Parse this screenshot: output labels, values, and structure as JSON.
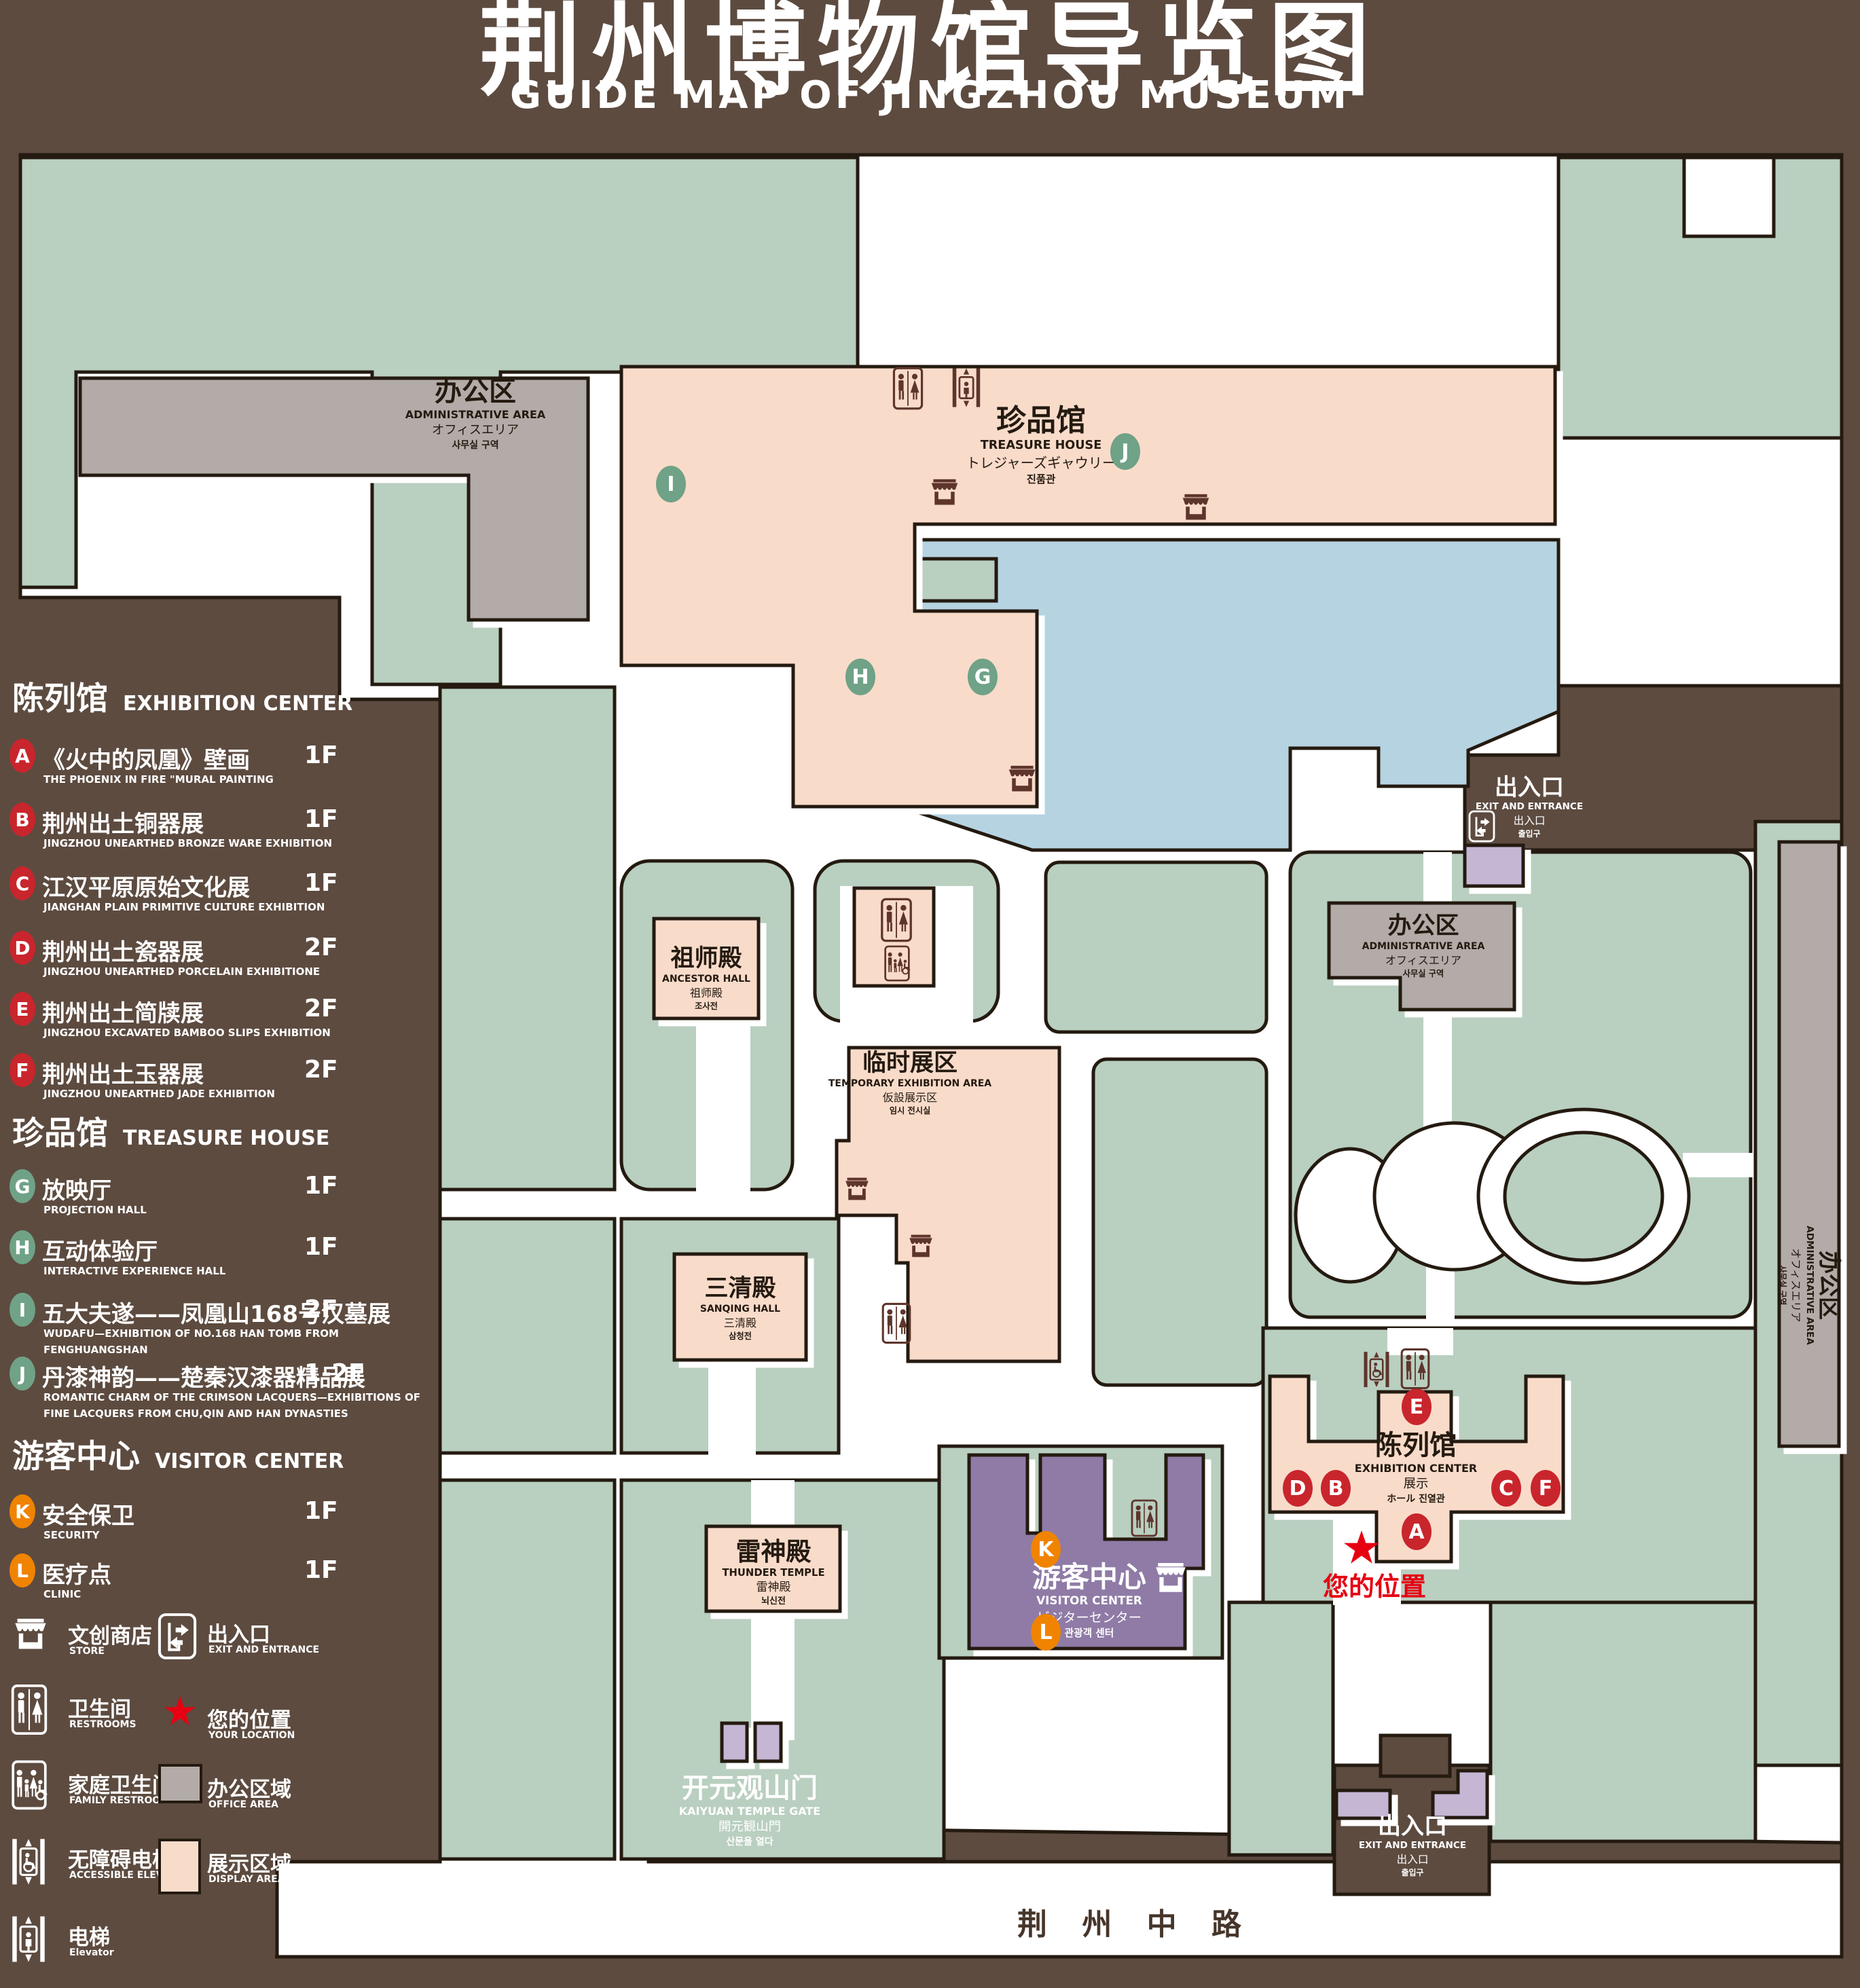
{
  "title": {
    "cn": "荆州博物馆导览图",
    "en": "GUIDE MAP OF JINGZHOU MUSEUM"
  },
  "legend": {
    "sections": [
      {
        "cn": "陈列馆",
        "en": "EXHIBITION CENTER",
        "badge_color": "#c9252d",
        "items": [
          {
            "letter": "A",
            "cn": "《火中的凤凰》壁画",
            "en": "THE PHOENIX IN FIRE \"MURAL PAINTING",
            "floor": "1F"
          },
          {
            "letter": "B",
            "cn": "荆州出土铜器展",
            "en": "JINGZHOU UNEARTHED BRONZE WARE EXHIBITION",
            "floor": "1F"
          },
          {
            "letter": "C",
            "cn": "江汉平原原始文化展",
            "en": "JIANGHAN PLAIN PRIMITIVE CULTURE EXHIBITION",
            "floor": "1F"
          },
          {
            "letter": "D",
            "cn": "荆州出土瓷器展",
            "en": "JINGZHOU UNEARTHED PORCELAIN EXHIBITIONE",
            "floor": "2F"
          },
          {
            "letter": "E",
            "cn": "荆州出土简牍展",
            "en": "JINGZHOU EXCAVATED BAMBOO SLIPS EXHIBITION",
            "floor": "2F"
          },
          {
            "letter": "F",
            "cn": "荆州出土玉器展",
            "en": "JINGZHOU UNEARTHED JADE EXHIBITION",
            "floor": "2F"
          }
        ]
      },
      {
        "cn": "珍品馆",
        "en": "TREASURE HOUSE",
        "badge_color": "#6fa287",
        "items": [
          {
            "letter": "G",
            "cn": "放映厅",
            "en": "PROJECTION HALL",
            "floor": "1F"
          },
          {
            "letter": "H",
            "cn": "互动体验厅",
            "en": "INTERACTIVE EXPERIENCE HALL",
            "floor": "1F"
          },
          {
            "letter": "I",
            "cn": "五大夫遂——凤凰山168号汉墓展",
            "en": "WUDAFU—EXHIBITION OF NO.168 HAN TOMB FROM FENGHUANGSHAN",
            "floor": "2F"
          },
          {
            "letter": "J",
            "cn": "丹漆神韵——楚秦汉漆器精品展",
            "en": "ROMANTIC CHARM OF THE CRIMSON LACQUERS—EXHIBITIONS OF FINE LACQUERS FROM CHU,QIN AND HAN DYNASTIES",
            "floor": "1-2F"
          }
        ]
      },
      {
        "cn": "游客中心",
        "en": "VISITOR CENTER",
        "badge_color": "#f08300",
        "items": [
          {
            "letter": "K",
            "cn": "安全保卫",
            "en": "SECURITY",
            "floor": "1F"
          },
          {
            "letter": "L",
            "cn": "医疗点",
            "en": "CLINIC",
            "floor": "1F"
          }
        ]
      }
    ],
    "symbols": [
      {
        "icon": "store-icon",
        "cn": "文创商店",
        "en": "STORE"
      },
      {
        "icon": "restroom-icon",
        "cn": "卫生间",
        "en": "RESTROOMS"
      },
      {
        "icon": "family-restroom-icon",
        "cn": "家庭卫生间",
        "en": "FAMILY RESTROOMS"
      },
      {
        "icon": "accessible-elevator-icon",
        "cn": "无障碍电梯",
        "en": "ACCESSIBLE ELEVATOR"
      },
      {
        "icon": "elevator-icon",
        "cn": "电梯",
        "en": "Elevator"
      },
      {
        "icon": "exit-door-icon",
        "cn": "出入口",
        "en": "EXIT AND ENTRANCE"
      },
      {
        "icon": "your-location-star-icon",
        "cn": "您的位置",
        "en": "YOUR LOCATION"
      },
      {
        "icon": "office-area-swatch",
        "cn": "办公区域",
        "en": "OFFICE AREA"
      },
      {
        "icon": "display-area-swatch",
        "cn": "展示区域",
        "en": "DISPLAY AREA"
      }
    ]
  },
  "map_labels": {
    "admin-area-nw": {
      "lines": [
        "办公区",
        "ADMINISTRATIVE AREA",
        "オフィスエリア",
        "사무실 구역"
      ]
    },
    "treasure-house": {
      "lines": [
        "珍品馆",
        "TREASURE HOUSE",
        "トレジャーズギャウリー",
        "진품관"
      ]
    },
    "ancestor-hall": {
      "lines": [
        "祖师殿",
        "ANCESTOR HALL",
        "祖师殿",
        "조사전"
      ]
    },
    "temporary-exhibition-area": {
      "lines": [
        "临时展区",
        "TEMPORARY EXHIBITION AREA",
        "仮設展示区",
        "임시 전시실"
      ]
    },
    "admin-area-east": {
      "lines": [
        "办公区",
        "ADMINISTRATIVE AREA",
        "オフィスエリア",
        "사무실 구역"
      ]
    },
    "admin-area-right-column": {
      "lines": [
        "办公区",
        "ADMINISTRATIVE AREA",
        "オフィスエリア",
        "사무실 구역"
      ]
    },
    "sanqing-hall": {
      "lines": [
        "三清殿",
        "SANQING HALL",
        "三清殿",
        "삼청전"
      ]
    },
    "thunder-temple": {
      "lines": [
        "雷神殿",
        "THUNDER TEMPLE",
        "雷神殿",
        "뇌신전"
      ]
    },
    "visitor-center": {
      "lines": [
        "游客中心",
        "VISITOR CENTER",
        "ビジターセンター",
        "관광객 센터"
      ]
    },
    "exhibition-center": {
      "lines": [
        "陈列馆",
        "EXHIBITION CENTER",
        "展示",
        "ホール 진열관"
      ]
    },
    "exit-northeast": {
      "lines": [
        "出入口",
        "EXIT AND ENTRANCE",
        "出入口",
        "출입구"
      ]
    },
    "exit-south": {
      "lines": [
        "出入口",
        "EXIT AND ENTRANCE",
        "出入口",
        "출입구"
      ]
    },
    "kaiyuan-temple-gate": {
      "lines": [
        "开元观山门",
        "KAIYUAN TEMPLE GATE",
        "開元観山門",
        "산문을 열다"
      ]
    },
    "road": {
      "lines": [
        "荆 州 中 路"
      ]
    },
    "your-location": {
      "lines": [
        "您的位置"
      ]
    }
  },
  "markers": [
    {
      "letter": "A",
      "group": "red"
    },
    {
      "letter": "B",
      "group": "red"
    },
    {
      "letter": "C",
      "group": "red"
    },
    {
      "letter": "D",
      "group": "red"
    },
    {
      "letter": "E",
      "group": "red"
    },
    {
      "letter": "F",
      "group": "red"
    },
    {
      "letter": "G",
      "group": "green"
    },
    {
      "letter": "H",
      "group": "green"
    },
    {
      "letter": "I",
      "group": "green"
    },
    {
      "letter": "J",
      "group": "green"
    },
    {
      "letter": "K",
      "group": "orange"
    },
    {
      "letter": "L",
      "group": "orange"
    }
  ],
  "colors": {
    "background": "#5d4b40",
    "ground_green": "#b9cfc0",
    "display_area_pink": "#f9dbca",
    "office_area_gray": "#b2aba7",
    "visitor_center_purple": "#8f7ba6",
    "gate_purple": "#c5b6d4",
    "lake_blue": "#b6d3e1",
    "outline": "#241a10",
    "icon_maroon": "#5e352b",
    "badge_red": "#c9252d",
    "badge_green": "#6fa287",
    "badge_orange": "#f08300",
    "location_red": "#e60012"
  }
}
